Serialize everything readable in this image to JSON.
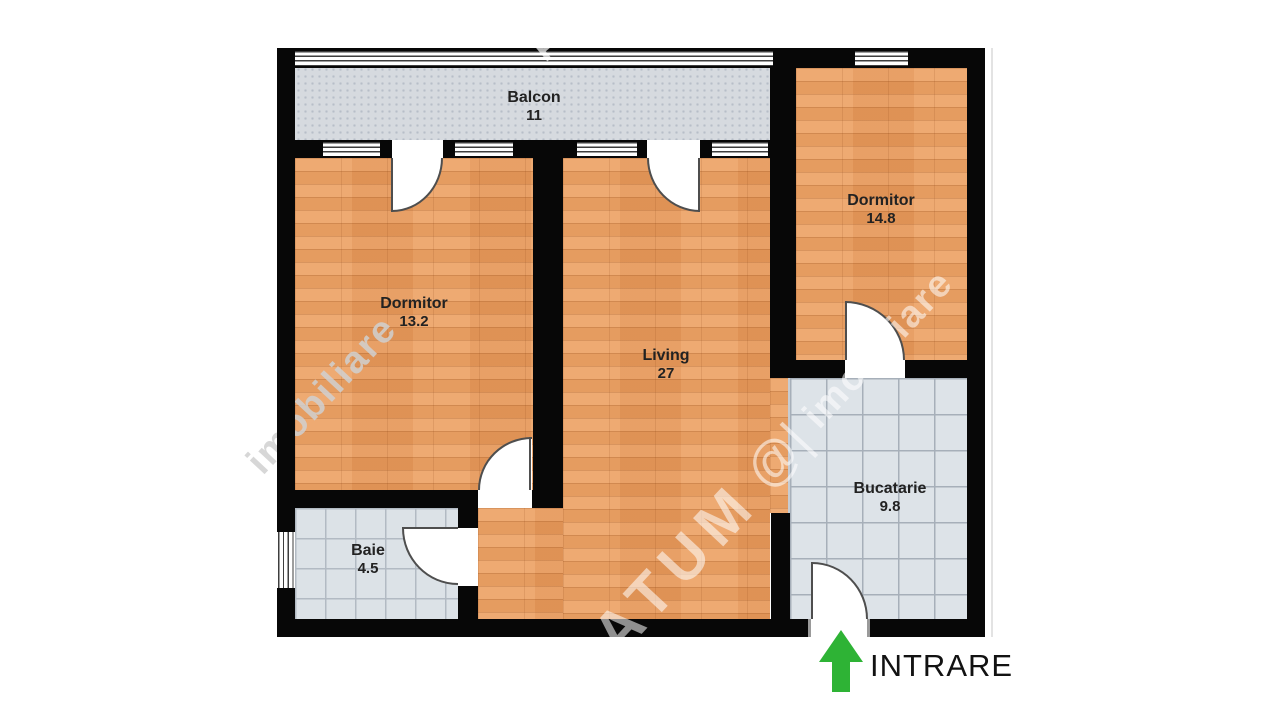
{
  "plan": {
    "rooms": [
      {
        "name": "Balcon",
        "area": "11"
      },
      {
        "name": "Dormitor",
        "area": "13.2"
      },
      {
        "name": "Living",
        "area": "27"
      },
      {
        "name": "Dormitor",
        "area": "14.8"
      },
      {
        "name": "Bucatarie",
        "area": "9.8"
      },
      {
        "name": "Baie",
        "area": "4.5"
      }
    ]
  },
  "entrance": {
    "label": "INTRARE",
    "arrow_color": "#2eb335"
  },
  "watermark": {
    "brand": "ATUM",
    "logo_glyph": "@|",
    "site": "imobiliare",
    "fragment": "P"
  },
  "colors": {
    "wall": "#070707",
    "wood_floor": "#ec9f60",
    "kitchen_tile": "#dde3e8",
    "bath_tile": "#dce2e7",
    "balcony_floor": "#d6dadf"
  }
}
